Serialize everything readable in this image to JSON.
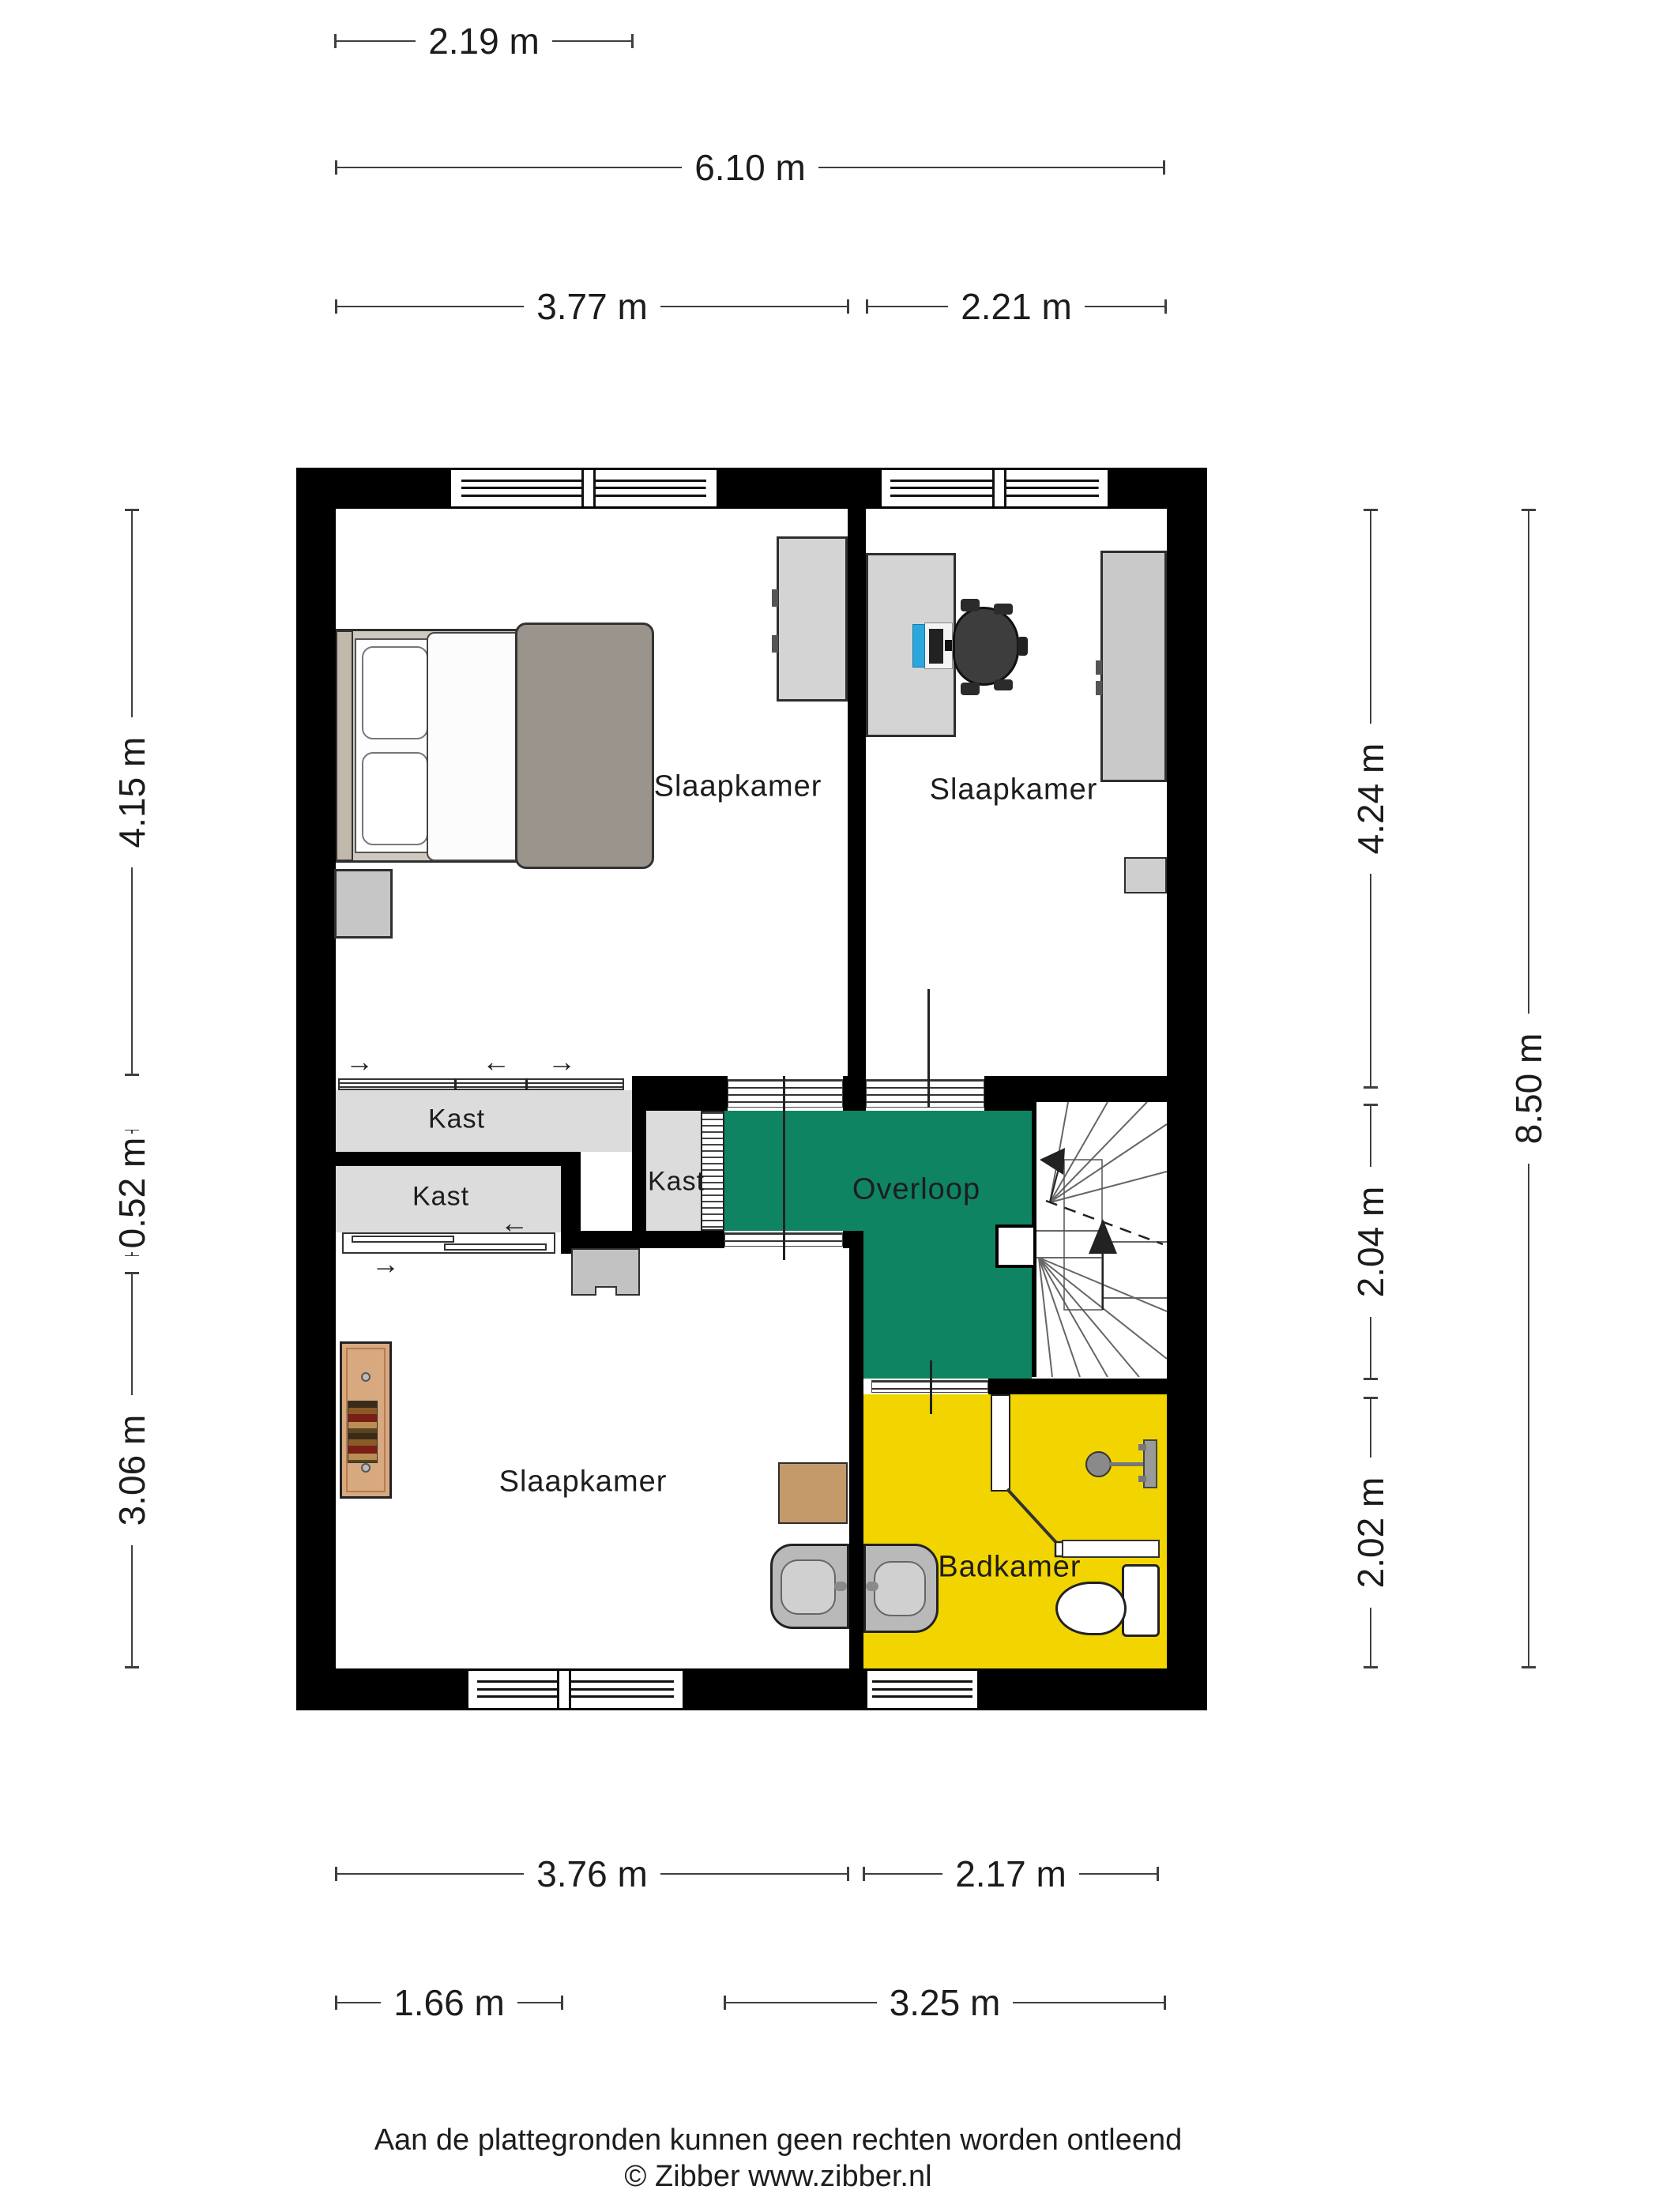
{
  "floorplan": {
    "room_labels": {
      "bedroom_top_left": "Slaapkamer",
      "bedroom_top_right": "Slaapkamer",
      "bedroom_bottom": "Slaapkamer",
      "landing": "Overloop",
      "bathroom": "Badkamer",
      "closet_top": "Kast",
      "closet_bottom": "Kast",
      "closet_small": "Kast"
    },
    "dimensions": {
      "top": [
        "2.19 m",
        "6.10 m",
        "3.77 m",
        "2.21 m"
      ],
      "left": [
        "4.15 m",
        "0.52 m",
        "3.06 m"
      ],
      "right": [
        "4.24 m",
        "2.04 m",
        "2.02 m",
        "8.50 m"
      ],
      "bottom": [
        "3.76 m",
        "2.17 m",
        "1.66 m",
        "3.25 m"
      ]
    },
    "icons": {
      "slide_arrow_right": "→",
      "slide_arrow_left": "←"
    },
    "colors": {
      "wall_black": "#000000",
      "landing_green": "#0F8462",
      "bathroom_yellow": "#F2D500",
      "closet_gray": "#DCDCDC",
      "furniture_gray": "#CCCCCC",
      "wood_tan": "#D8A87E",
      "laptop_blue": "#2AA7DD"
    },
    "footer": {
      "line1": "Aan de plattegronden kunnen geen rechten worden ontleend",
      "line2": "© Zibber www.zibber.nl"
    }
  }
}
